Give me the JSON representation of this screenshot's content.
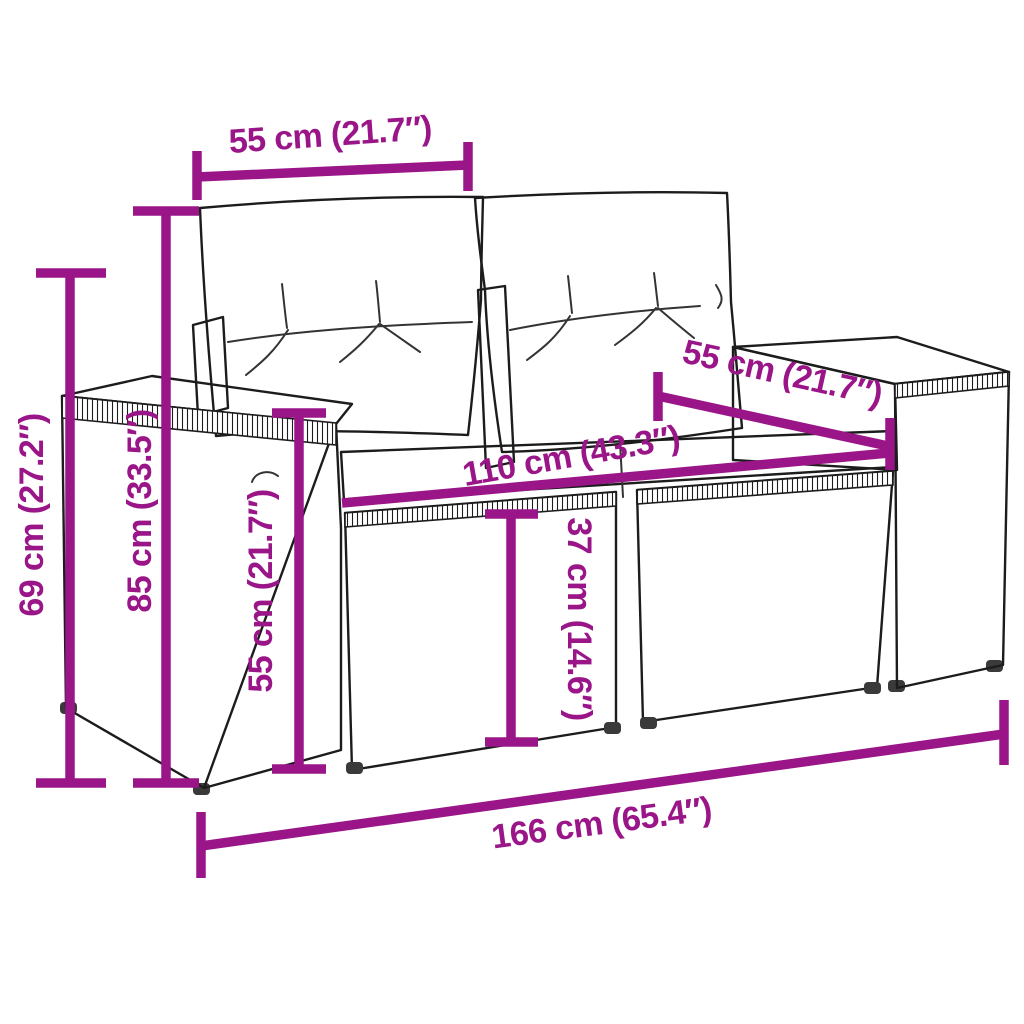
{
  "diagram": {
    "type": "product-dimension-diagram",
    "subject": "poly-rattan-garden-loveseat-with-cushions",
    "background_color": "#ffffff",
    "accent_color": "#9a1588",
    "outline_color": "#1c1c1c",
    "labels": {
      "arm_depth_top": "55 cm (21.7″)",
      "total_height": "69 cm (27.2″)",
      "back_height": "85 cm (33.5″)",
      "arm_height": "55 cm (21.7″)",
      "seat_depth": "55 cm (21.7″)",
      "seat_width": "110 cm (43.3″)",
      "seat_height": "37 cm (14.6″)",
      "total_width": "166 cm (65.4″)"
    }
  }
}
